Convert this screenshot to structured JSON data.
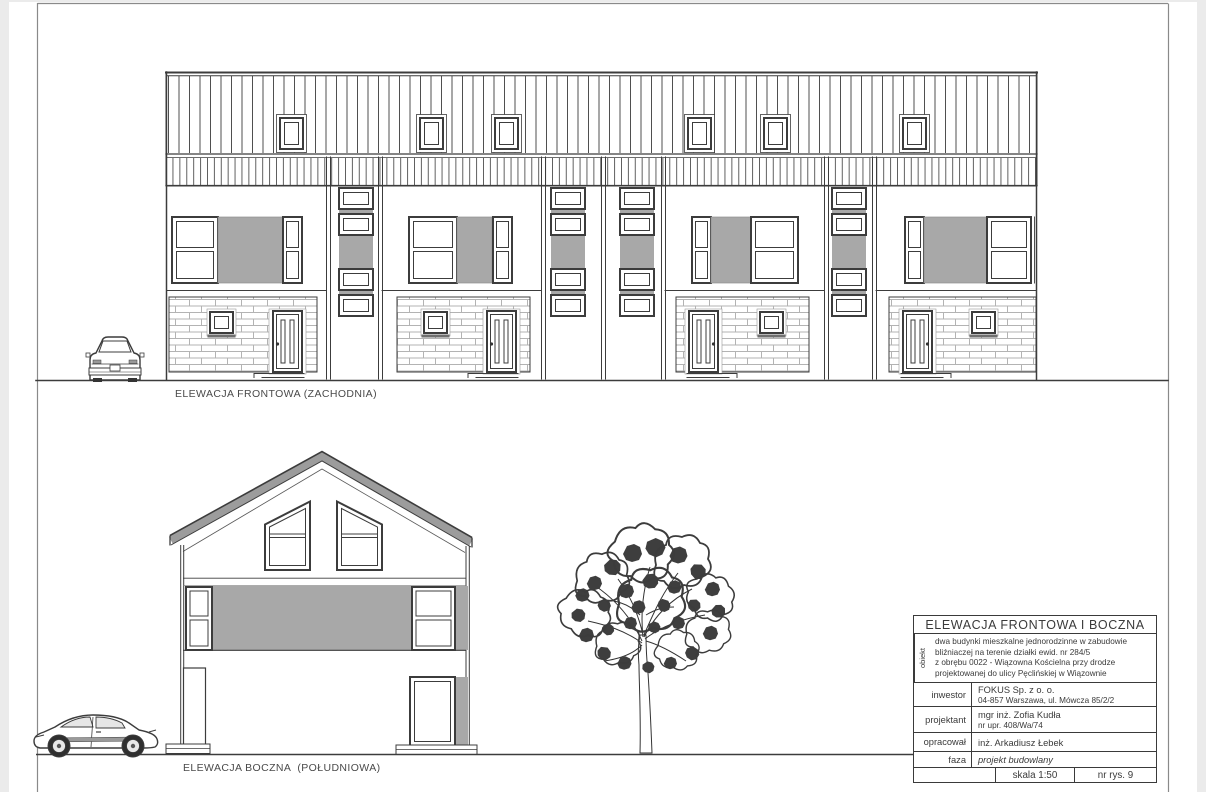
{
  "colors": {
    "sheet": "#ffffff",
    "margin": "#ebebeb",
    "line": "#3c3c3c",
    "panel_gray": "#a8a8a8",
    "roof_gray": "#9c9c9c",
    "brick_mortar": "#b3b3b3",
    "frame": "#8a8a8a"
  },
  "drawings": {
    "front_elevation": {
      "label": "ELEWACJA FRONTOWA (ZACHODNIA)"
    },
    "side_elevation": {
      "label": "ELEWACJA BOCZNA  (POŁUDNIOWA)"
    }
  },
  "title_block": {
    "title": "ELEWACJA FRONTOWA I BOCZNA",
    "object_label": "obiekt",
    "object_lines": [
      "dwa budynki mieszkalne jednorodzinne w zabudowie",
      "bliźniaczej na terenie działki ewid. nr 284/5",
      "z obrębu 0022 - Wiązowna Kościelna przy drodze",
      "projektowanej do ulicy Pęclińskiej w Wiązownie"
    ],
    "investor_label": "inwestor",
    "investor_name": "FOKUS Sp. z o. o.",
    "investor_address": "04-857 Warszawa, ul. Mówcza 85/2/2",
    "designer_label": "projektant",
    "designer_name": "mgr inż. Zofia Kudła",
    "designer_license": "nr upr. 408/Wa/74",
    "prepared_label": "opracował",
    "prepared_name": "inż. Arkadiusz Łebek",
    "phase_label": "faza",
    "phase_value": "projekt budowlany",
    "scale": "skala 1:50",
    "drawing_no": "nr rys. 9"
  }
}
